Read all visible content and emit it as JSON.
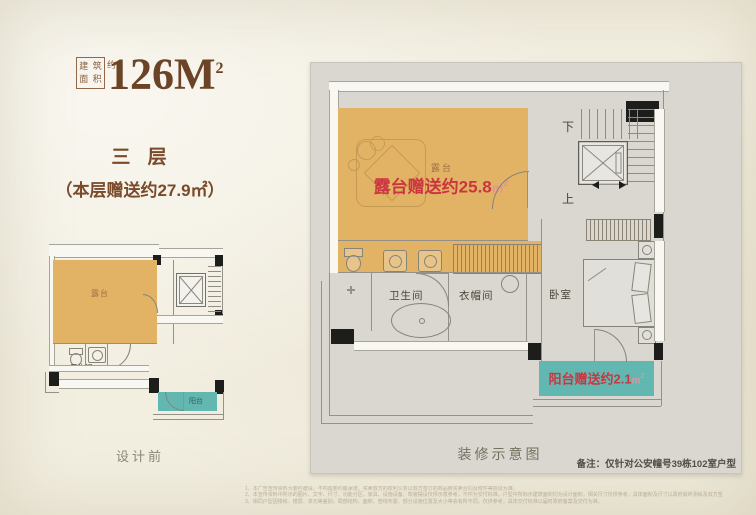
{
  "colors": {
    "accent_orange": "#e3b365",
    "accent_teal": "#62b8b1",
    "highlight_red": "#cb3540",
    "brand_brown": "#6b4326",
    "paper": "#f2eee0"
  },
  "header": {
    "seal_chars": [
      "建",
      "筑",
      "面",
      "积"
    ],
    "seal_suffix": "约",
    "area_value": "126M",
    "area_sup": "2",
    "floor_label": "三 层",
    "bonus_note": "（本层赠送约27.9㎡）"
  },
  "left_plan": {
    "caption": "设计前",
    "labels": {
      "terrace": "露台",
      "bathroom": "卫生间",
      "balcony": "阳台"
    }
  },
  "right_plan": {
    "caption": "装修示意图",
    "labels": {
      "terrace": "露台",
      "bathroom": "卫生间",
      "closet": "衣帽间",
      "bedroom": "卧室",
      "stairs_up": "上",
      "stairs_down": "下"
    },
    "terrace_gift": {
      "text": "露台赠送约25.8",
      "unit": "m",
      "sup": "2"
    },
    "balcony_gift": {
      "text": "阳台赠送约2.1",
      "unit": "m",
      "sup": "2"
    }
  },
  "footer": {
    "note": "备注：仅针对公安幢号39栋102室户型",
    "disclaimers": [
      "1、本广告宣传资料为要约邀请，不构成要约或承诺，买卖双方的权利义务以双方签订的商品房买卖合同及附件等协议为准。",
      "2、本宣传资料中所示的图片、文字、尺寸、功能分区、家具、设施设备、软装摆设仅供示意参考，不作为交付标准，户型中所标示建筑面积均为设计面积，相关尺寸仅供参考，具体面积及尺寸以政府最终测绘及双方签订的商品房买卖合同约定为准，楼栋尺寸及交房标准详见双方签订的商品房买卖合同约定为准。",
      "3、相同户型因楼栋、楼层、单元等差别，局部结构、面积、管线布置、部分设施位置及大小等会有所不同，仅供参考，具体交付标准以届时政府备案及交付为准。"
    ]
  }
}
